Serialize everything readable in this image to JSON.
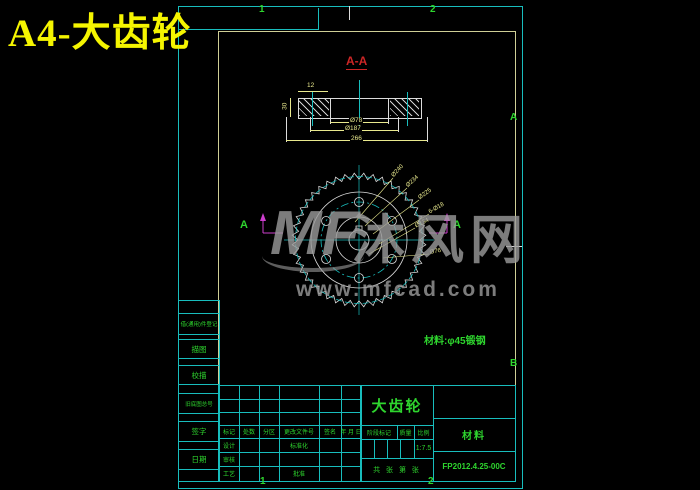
{
  "page_title": "A4-大齿轮",
  "colors": {
    "background": "#000000",
    "line_cyan": "#18bdbd",
    "frame_inner": "#cfcf96",
    "text_green": "#2ed52e",
    "title_yellow": "#f5f500",
    "dim_yellow": "#e9e98e",
    "section_red": "#cc2626",
    "cut_magenta": "#cc3ecc",
    "watermark_gray": "#9b9b9b",
    "line_white": "#dcdcdc"
  },
  "border_zones": {
    "top": [
      "1",
      "2"
    ],
    "bottom": [
      "1",
      "2"
    ],
    "right": [
      "A",
      "B"
    ]
  },
  "section_view": {
    "label": "A-A",
    "dim_top": "12",
    "dim_left": "30",
    "dim_inner": "Ø78",
    "dim_mid": "Ø187",
    "dim_overall": "266"
  },
  "front_view": {
    "section_letter": "A",
    "teeth": 44,
    "r_tip": 67,
    "r_root": 61,
    "circles": [
      {
        "r": 63.5,
        "c": "#18bdbd",
        "dash": "6 3"
      },
      {
        "r": 48,
        "c": "#dcdcdc",
        "dash": ""
      },
      {
        "r": 38,
        "c": "#18bdbd",
        "dash": "8 3 2 3"
      },
      {
        "r": 23,
        "c": "#dcdcdc",
        "dash": ""
      },
      {
        "r": 10,
        "c": "#dcdcdc",
        "dash": ""
      }
    ],
    "holes": {
      "count": 6,
      "r_pos": 38,
      "r_hole": 4.5,
      "start_deg": 30
    },
    "leaders": [
      {
        "x1": -4,
        "y1": -18,
        "x2": 34,
        "y2": -62,
        "rot": -48,
        "label": "Ø240"
      },
      {
        "x1": 6,
        "y1": -14,
        "x2": 48,
        "y2": -52,
        "rot": -42,
        "label": "Ø234"
      },
      {
        "x1": 14,
        "y1": -6,
        "x2": 60,
        "y2": -40,
        "rot": -36,
        "label": "Ø225"
      },
      {
        "x1": 20,
        "y1": 4,
        "x2": 70,
        "y2": -26,
        "rot": -30,
        "label": "6-Ø18"
      },
      {
        "x1": 10,
        "y1": 14,
        "x2": 56,
        "y2": -12,
        "rot": -26,
        "label": "Ø134"
      },
      {
        "x1": 24,
        "y1": 18,
        "x2": 70,
        "y2": 14,
        "rot": -10,
        "label": "Ø76"
      }
    ]
  },
  "material_note": "材料:φ45锻钢",
  "watermark": {
    "logo": "MF",
    "name": "沐风网",
    "url": "www.mfcad.com"
  },
  "left_table": {
    "rows": [
      "借(通用)件登记",
      "描图",
      "校描",
      "旧底图总号",
      "签字",
      "日期"
    ]
  },
  "title_block": {
    "header_cells": [
      "标记",
      "处数",
      "分区",
      "更改文件号",
      "签名",
      "年 月 日"
    ],
    "row_design": "设计",
    "row_check": "审核",
    "row_process": "工艺",
    "std_label": "标准化",
    "approve_label": "批准",
    "part_name": "大齿轮",
    "stage_label": "阶段标记",
    "mass_label": "质量",
    "scale_label": "比例",
    "scale_value": "1:7.5",
    "sheet_text": "共  张 第  张",
    "material_label": "材料",
    "drawing_no": "FP2012.4.25-00C"
  }
}
